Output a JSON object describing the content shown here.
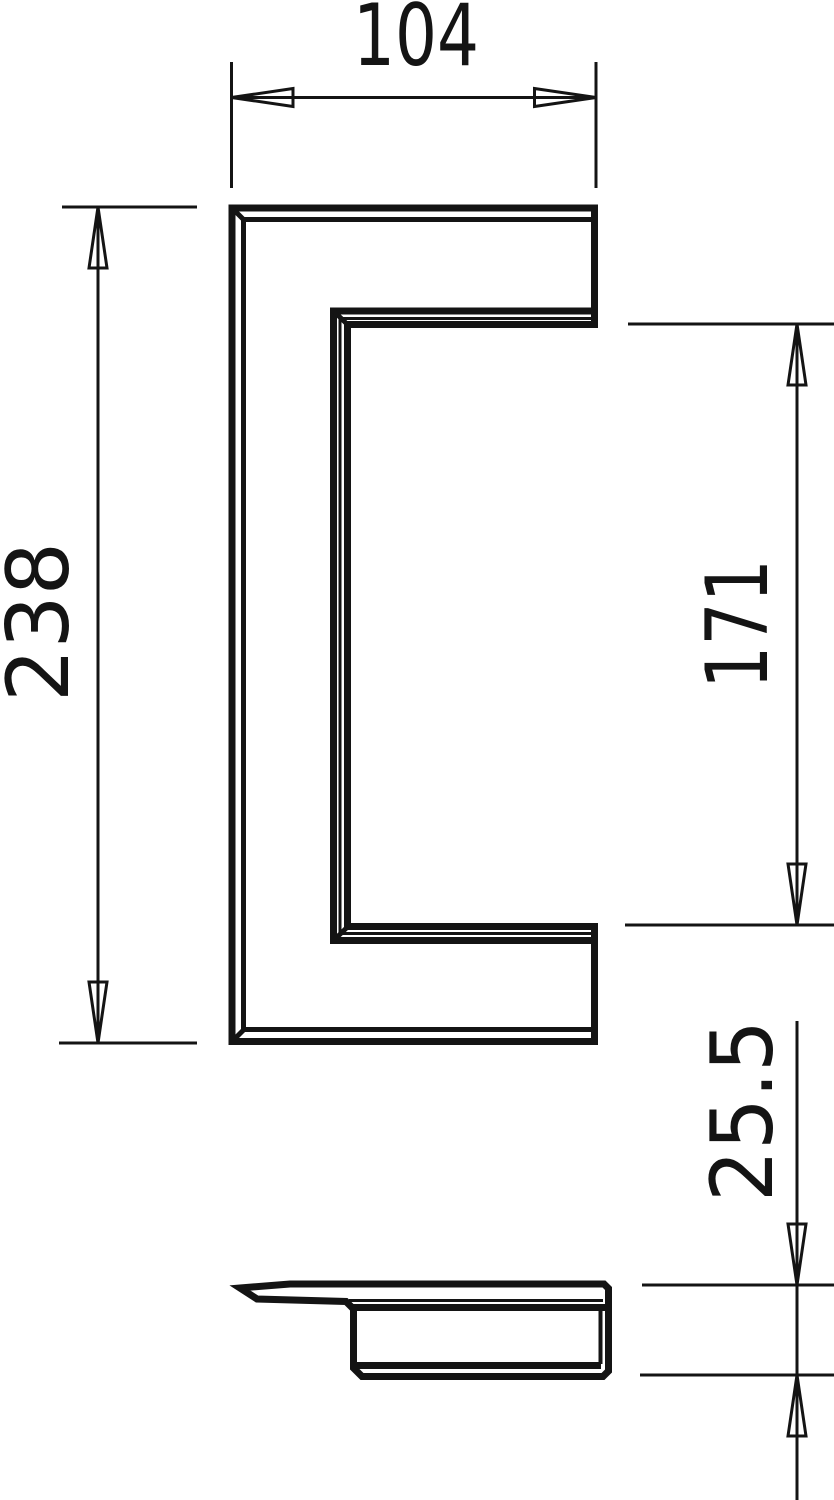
{
  "drawing": {
    "line_color": "#141414",
    "background_color": "#ffffff",
    "dimensions": {
      "width": {
        "value": "104",
        "orientation": "horizontal"
      },
      "height": {
        "value": "238",
        "orientation": "vertical"
      },
      "opening": {
        "value": "171",
        "orientation": "vertical"
      },
      "depth": {
        "value": "25.5",
        "orientation": "vertical"
      }
    }
  }
}
